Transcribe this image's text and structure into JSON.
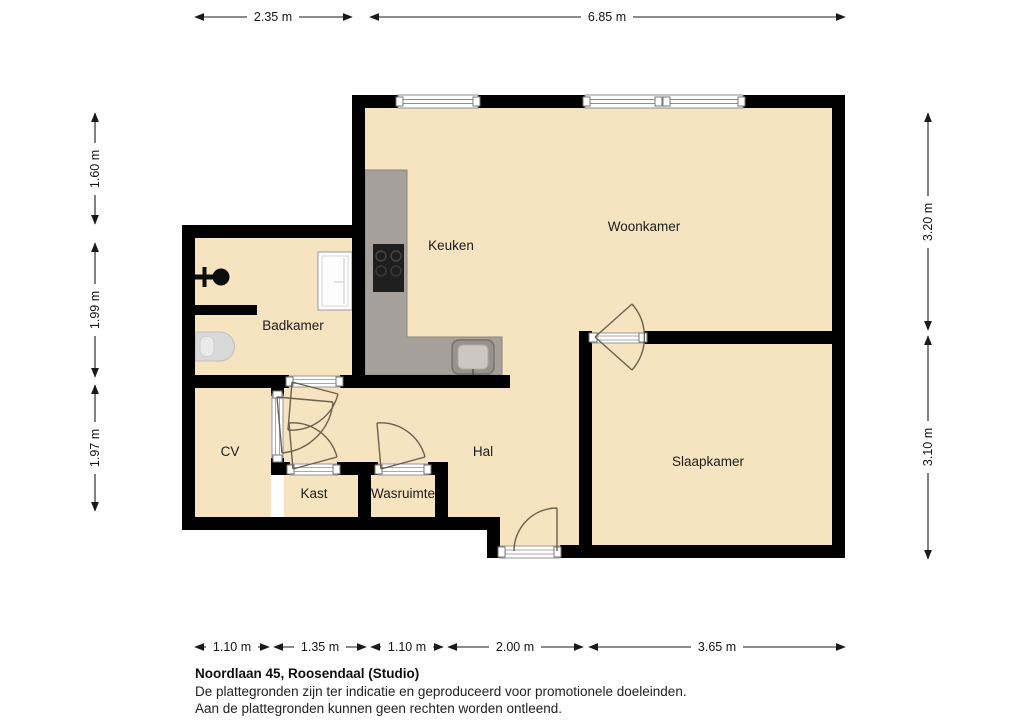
{
  "floorplan": {
    "address_title": "Noordlaan 45, Roosendaal (Studio)",
    "disclaimer": [
      "De plattegronden zijn ter indicatie en geproduceerd voor promotionele doeleinden.",
      "Aan de plattegronden kunnen geen rechten worden ontleend."
    ],
    "rooms": {
      "keuken": "Keuken",
      "woonkamer": "Woonkamer",
      "badkamer": "Badkamer",
      "cv": "CV",
      "hal": "Hal",
      "kast": "Kast",
      "wasruimte": "Wasruimte",
      "slaapkamer": "Slaapkamer"
    },
    "dimensions": {
      "top": [
        "2.35 m",
        "6.85 m"
      ],
      "left": [
        "1.60 m",
        "1.99 m",
        "1.97 m"
      ],
      "right": [
        "3.20 m",
        "3.10 m"
      ],
      "bottom": [
        "1.10 m",
        "1.35 m",
        "1.10 m",
        "2.00 m",
        "3.65 m"
      ]
    },
    "colors": {
      "floor": "#F6E3C0",
      "wall": "#000000",
      "counter": "#A5A099",
      "fixture_gray": "#D9D9D9",
      "door_arc": "#6B5F4E",
      "dimension": "#1A1A1A"
    }
  }
}
